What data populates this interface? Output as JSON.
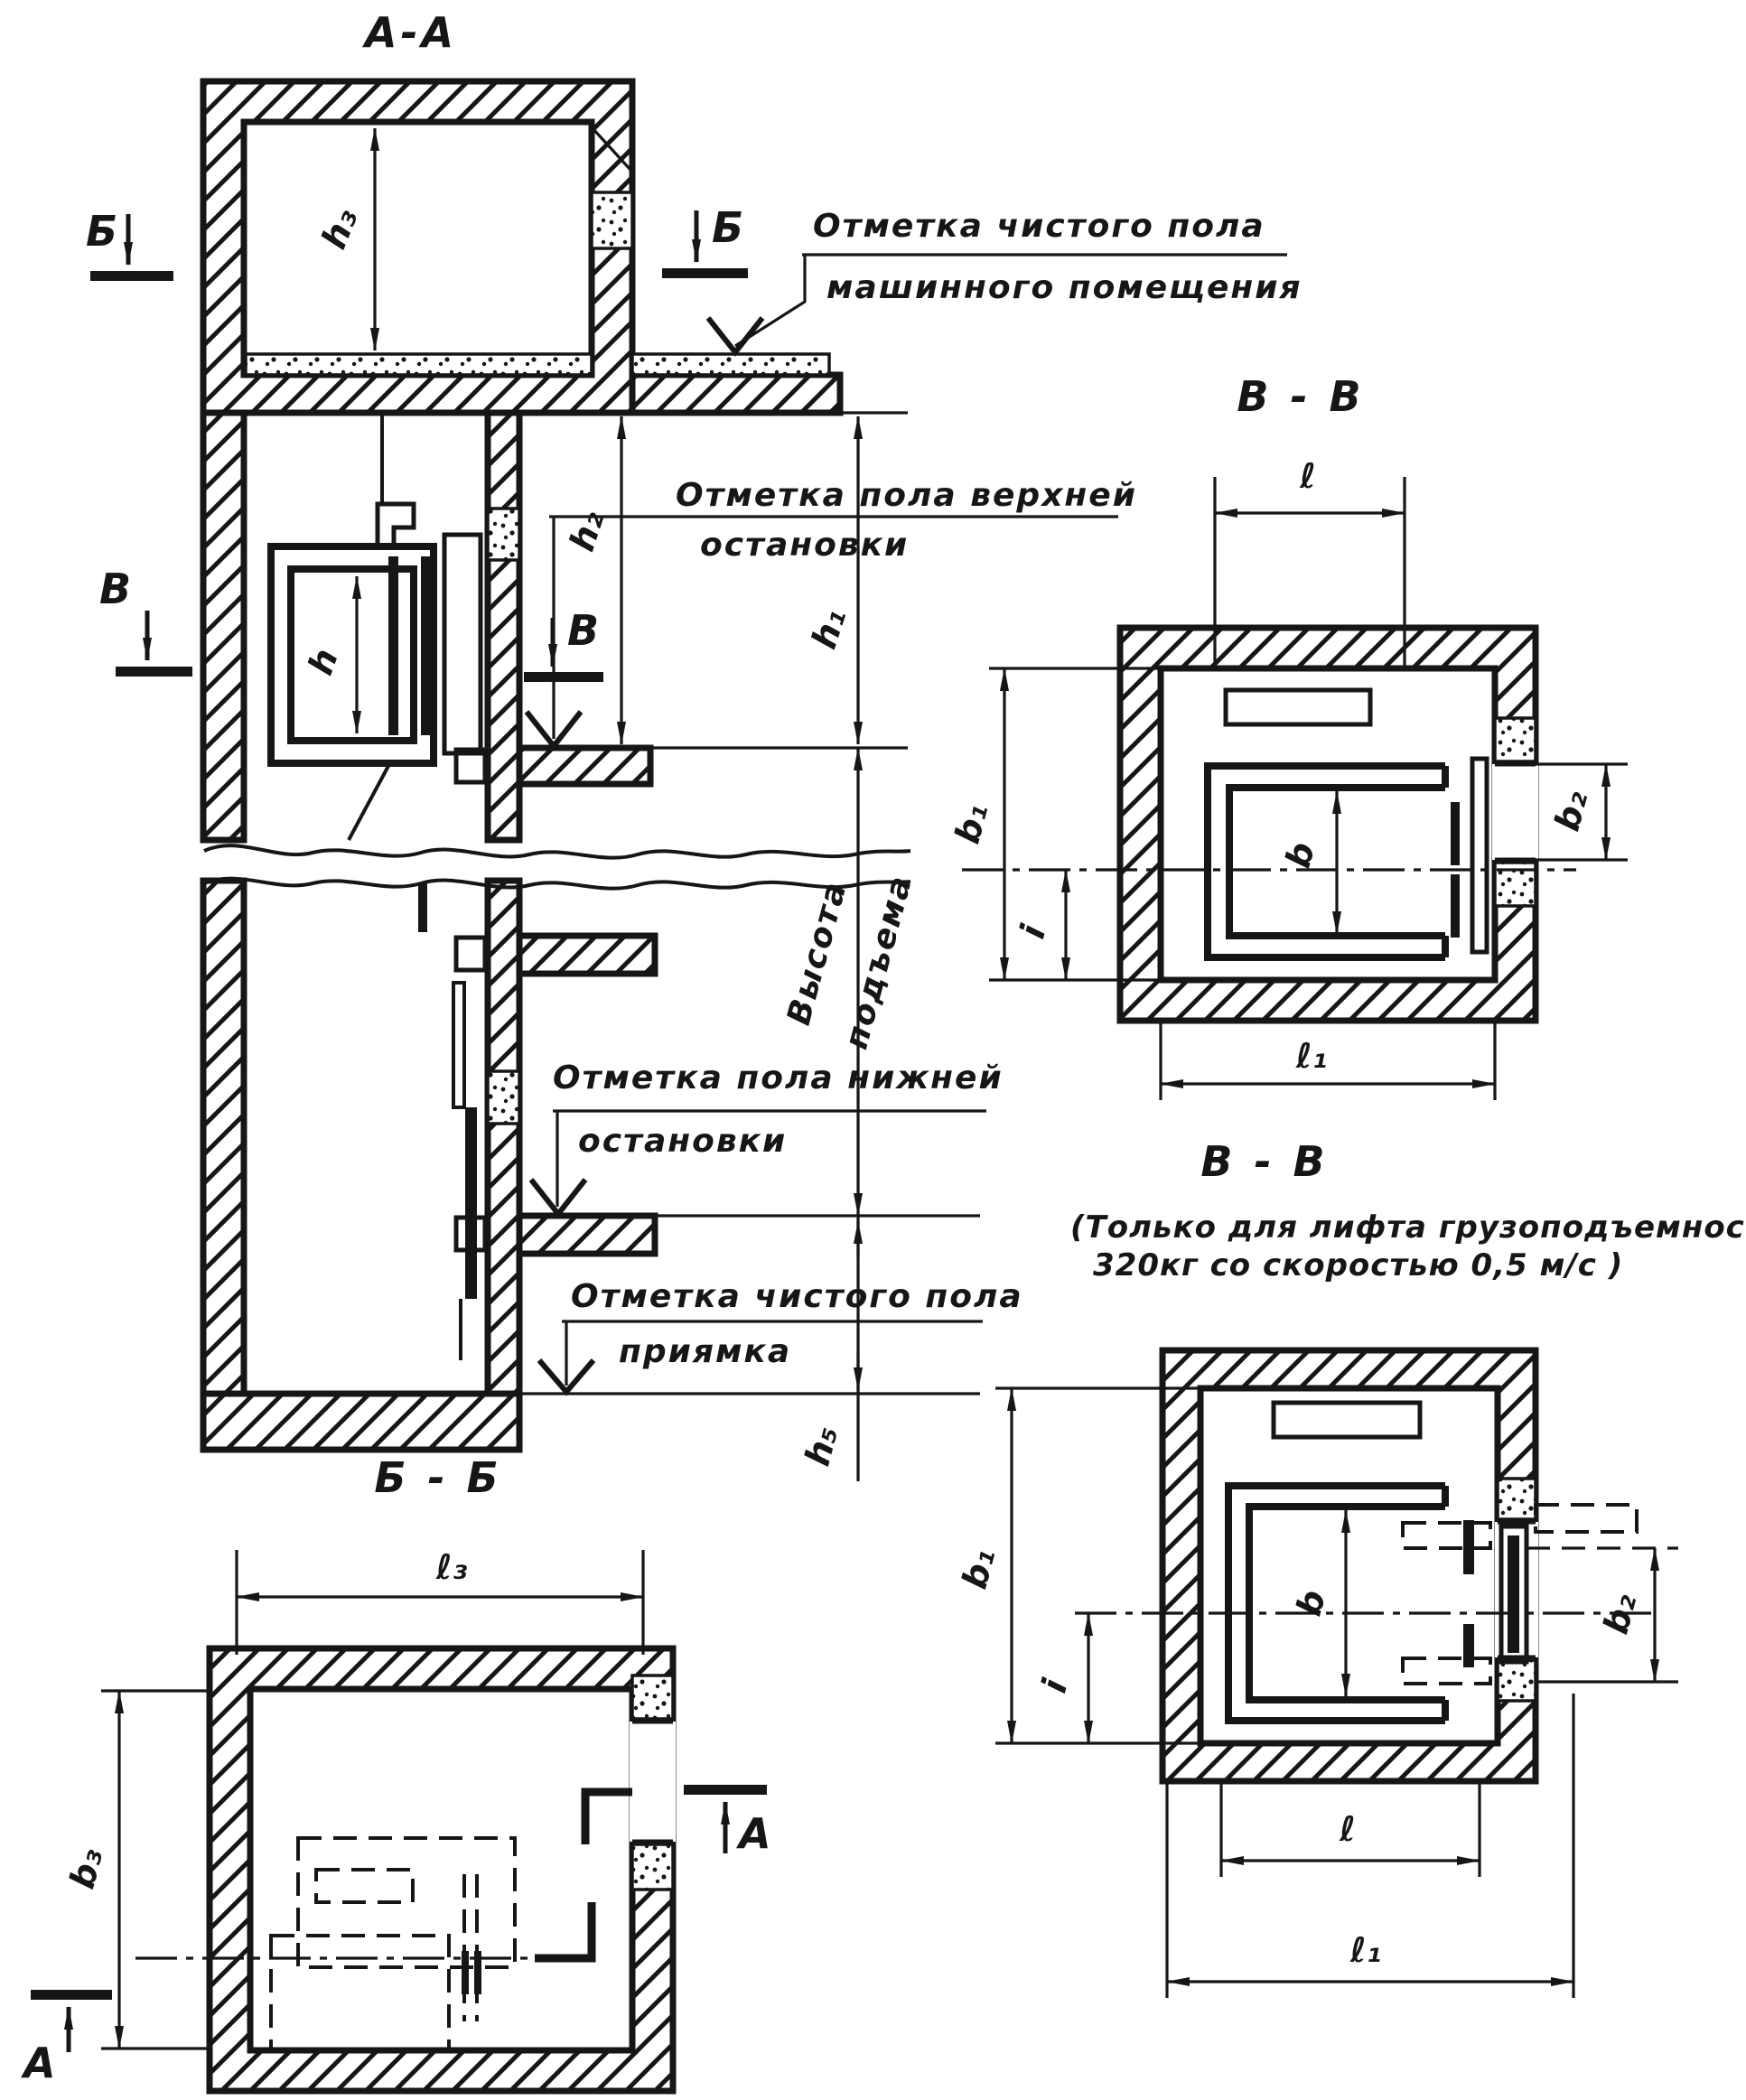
{
  "drawing": {
    "title_aa": "А-А",
    "title_bb": "Б - Б",
    "title_vv_top": "В - В",
    "title_vv_bottom": "В - В",
    "vv_note_line1": "(Только для лифта грузоподъемностью",
    "vv_note_line2": "320кг  со скоростью    0,5 м/с )",
    "annotations": {
      "machine_floor_1": "Отметка чистого пола",
      "machine_floor_2": "машинного помещения",
      "upper_stop_1": "Отметка пола  верхней",
      "upper_stop_2": "остановки",
      "lift_height_1": "Высота",
      "lift_height_2": "подъема",
      "lower_stop_1": "Отметка пола  нижней",
      "lower_stop_2": "остановки",
      "pit_floor_1": "Отметка чистого пола",
      "pit_floor_2": "приямка"
    },
    "dims": {
      "h": "h",
      "h1": "h₁",
      "h2": "h₂",
      "h3": "h₃",
      "h5": "h₅",
      "b": "b",
      "b1": "b₁",
      "b2": "b₂",
      "b3": "b₃",
      "i": "i",
      "l": "ℓ",
      "l1": "ℓ₁",
      "l3": "ℓ₃"
    },
    "section_marks": {
      "a": "А",
      "b": "Б",
      "v": "В"
    },
    "colors": {
      "ink": "#161616",
      "paper": "#ffffff"
    }
  }
}
